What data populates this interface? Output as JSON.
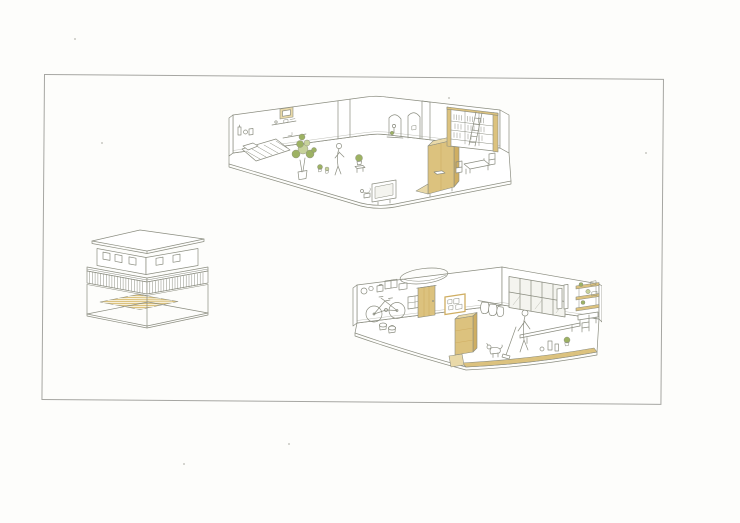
{
  "sheet": {
    "paper_bg": "#fdfdfb",
    "frame": "#a6a6a2"
  },
  "palette": {
    "line": "#8b8d80",
    "wood": "#dcc27e",
    "wood_light": "#e9d9a8",
    "wood_deep": "#cfae62",
    "green": "#9db263",
    "green_light": "#c7d29b",
    "glass": "#f4f4ef",
    "paper_bg": "#fdfdfb",
    "frame": "#a6a6a2"
  },
  "illustrations": [
    {
      "id": "upper-floor-interior",
      "kind": "isometric-cutaway-interior"
    },
    {
      "id": "house-exterior",
      "kind": "isometric-building-exterior"
    },
    {
      "id": "ground-floor-interior",
      "kind": "isometric-cutaway-interior"
    }
  ]
}
